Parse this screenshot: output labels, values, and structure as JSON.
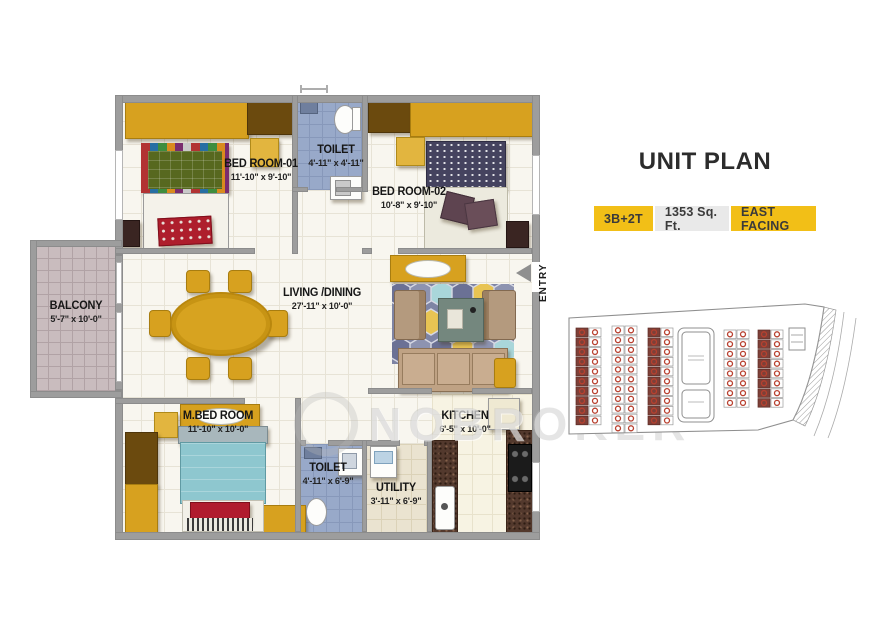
{
  "header": {
    "title": "UNIT PLAN"
  },
  "badges": {
    "config": "3B+2T",
    "area": "1353 Sq. Ft.",
    "facing": "EAST FACING"
  },
  "entry": {
    "label": "ENTRY"
  },
  "watermark": {
    "text": "NOBROKER"
  },
  "rooms": {
    "bedroom1": {
      "name": "BED ROOM-01",
      "dims": "11'-10\" x 9'-10\""
    },
    "toilet1": {
      "name": "TOILET",
      "dims": "4'-11\" x 4'-11\""
    },
    "bedroom2": {
      "name": "BED ROOM-02",
      "dims": "10'-8\" x 9'-10\""
    },
    "balcony": {
      "name": "BALCONY",
      "dims": "5'-7\" x 10'-0\""
    },
    "living": {
      "name": "LIVING /DINING",
      "dims": "27'-11\" x 10'-0\""
    },
    "mbedroom": {
      "name": "M.BED ROOM",
      "dims": "11'-10\" x 10'-0\""
    },
    "toilet2": {
      "name": "TOILET",
      "dims": "4'-11\" x 6'-9\""
    },
    "utility": {
      "name": "UTILITY",
      "dims": "3'-11\" x 6'-9\""
    },
    "kitchen": {
      "name": "KITCHEN",
      "dims": "6'-5\" x 10'-0\""
    }
  },
  "colors": {
    "accent_yellow": "#F2BF17",
    "badge_gray": "#E9E9E9",
    "wall_gray": "#9D9D9D",
    "toilet_blue": "#98A9C9",
    "balcony_pink": "#C9BCBE",
    "furniture_mustard": "#D7A11F",
    "site_unit_red": "#B8402F"
  },
  "site_plan": {
    "cell": {
      "w": 12,
      "h": 9.8
    },
    "columns": [
      {
        "x": 14,
        "y": 30,
        "rows": 10,
        "style": "dark"
      },
      {
        "x": 27,
        "y": 30,
        "rows": 10,
        "style": "light"
      },
      {
        "x": 50,
        "y": 28,
        "rows": 11,
        "style": "light"
      },
      {
        "x": 63,
        "y": 28,
        "rows": 11,
        "style": "light"
      },
      {
        "x": 86,
        "y": 30,
        "rows": 10,
        "style": "dark"
      },
      {
        "x": 99,
        "y": 30,
        "rows": 10,
        "style": "light"
      },
      {
        "x": 162,
        "y": 32,
        "rows": 8,
        "style": "light"
      },
      {
        "x": 175,
        "y": 32,
        "rows": 8,
        "style": "light"
      },
      {
        "x": 196,
        "y": 32,
        "rows": 8,
        "style": "dark"
      },
      {
        "x": 209,
        "y": 32,
        "rows": 8,
        "style": "light"
      }
    ]
  }
}
